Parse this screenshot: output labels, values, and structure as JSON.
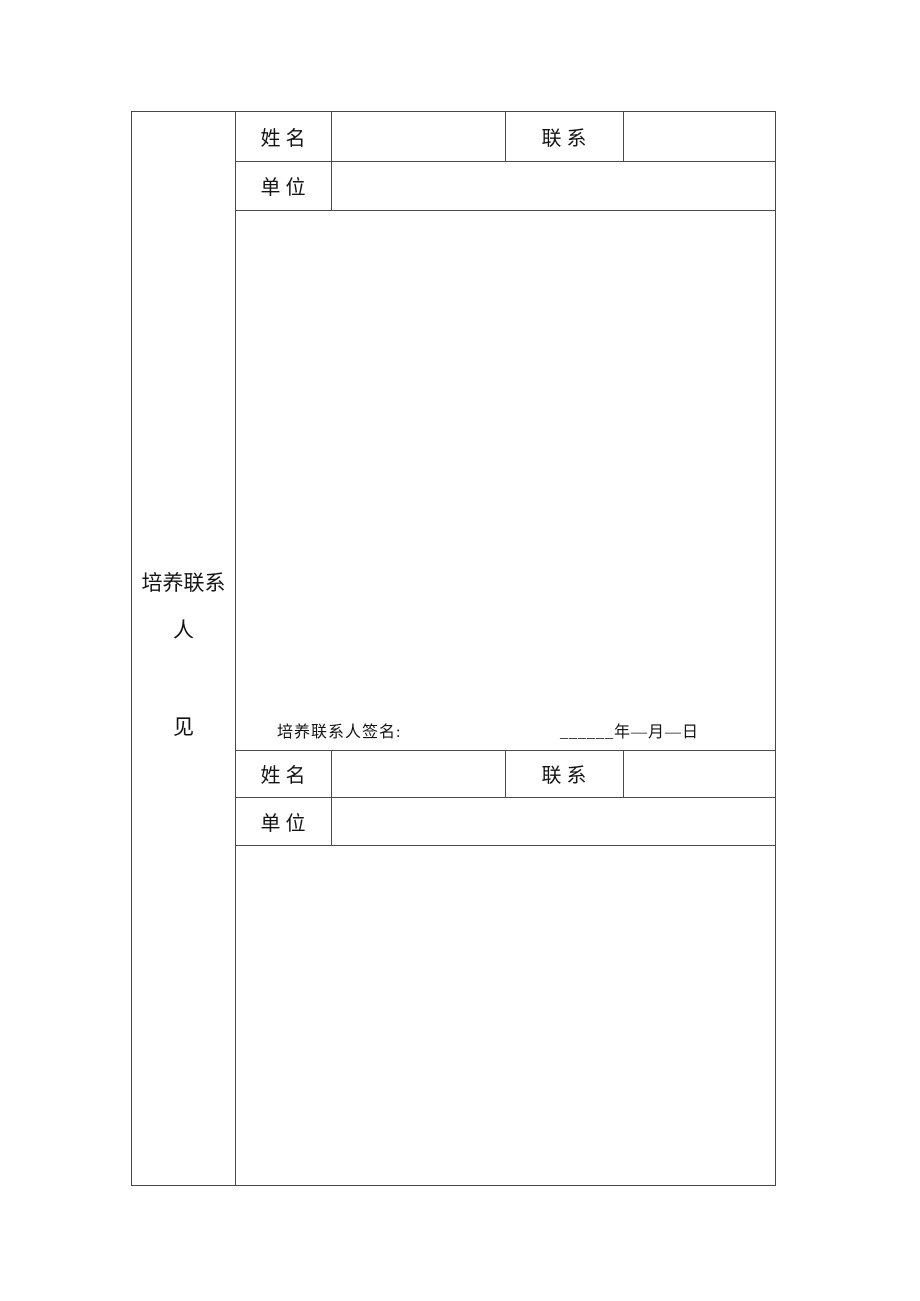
{
  "document": {
    "background_color": "#ffffff",
    "border_color": "#4a4a4a",
    "text_color": "#141414"
  },
  "row_header": {
    "full_label": "培养联系人见",
    "lines": [
      "培养联系",
      "人",
      "见"
    ]
  },
  "section1": {
    "name_label": "姓名",
    "name_value": "",
    "contact_label": "联系",
    "contact_value": "",
    "unit_label": "单位",
    "unit_value": "",
    "opinion_text": "",
    "signature_label": "培养联系人签名:",
    "signature_date": "______年—月—日"
  },
  "section2": {
    "name_label": "姓名",
    "name_value": "",
    "contact_label": "联系",
    "contact_value": "",
    "unit_label": "单位",
    "unit_value": "",
    "opinion_text": ""
  }
}
